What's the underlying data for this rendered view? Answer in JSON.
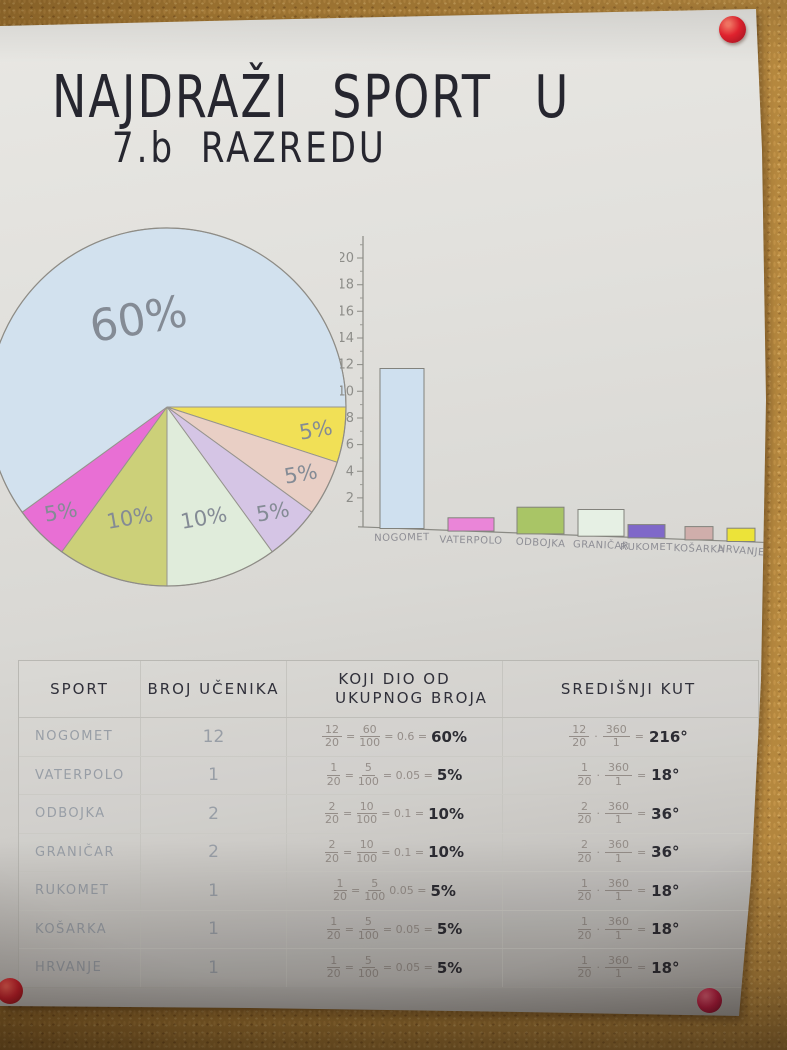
{
  "colors": {
    "cork_board": "#a97c35",
    "poster_paper": "#dddcd8",
    "ink": "#2b2b33",
    "pencil": "#8f939b",
    "pin_red": "#ea2430",
    "pin_crimson": "#bd1c42"
  },
  "title": {
    "line1": "NAJDRAŽI SPORT U",
    "line2": "7.b RAZREDU"
  },
  "chart_data": [
    {
      "type": "pie",
      "title": "NAJDRAŽI SPORT U 7.b RAZREDU",
      "total_students": 20,
      "layout": "slices drawn clockwise starting at 3 o'clock; 60% slice fills remainder",
      "slices": [
        {
          "sport": "HRVANJE",
          "percent": 5,
          "label": "5%",
          "color": "#f1e056"
        },
        {
          "sport": "KOŠARKA",
          "percent": 5,
          "label": "5%",
          "color": "#e9cfc5"
        },
        {
          "sport": "RUKOMET",
          "percent": 5,
          "label": "5%",
          "color": "#d5c5e5"
        },
        {
          "sport": "GRANIČAR",
          "percent": 10,
          "label": "10%",
          "color": "#e0ecdb"
        },
        {
          "sport": "ODBOJKA",
          "percent": 10,
          "label": "10%",
          "color": "#ccd079"
        },
        {
          "sport": "VATERPOLO",
          "percent": 5,
          "label": "5%",
          "color": "#e86fd4"
        },
        {
          "sport": "NOGOMET",
          "percent": 60,
          "label": "60%",
          "color": "#d2e1ee"
        }
      ]
    },
    {
      "type": "bar",
      "title": "",
      "xlabel": "",
      "ylabel": "",
      "categories": [
        "NOGOMET",
        "VATERPOLO",
        "ODBOJKA",
        "GRANIČAR",
        "RUKOMET",
        "KOŠARKA",
        "HRVANJE"
      ],
      "values": [
        12,
        1,
        2,
        2,
        1,
        1,
        1
      ],
      "bar_colors": [
        "#cfe0ef",
        "#ea85d8",
        "#a9c566",
        "#e6f0e4",
        "#7f68c9",
        "#d0aeab",
        "#ece339"
      ],
      "yticks": [
        2,
        4,
        6,
        8,
        10,
        12,
        14,
        16,
        18,
        20
      ],
      "ylim": [
        0,
        21
      ],
      "grid": false,
      "legend": "none"
    },
    {
      "type": "table",
      "headers": {
        "col1": "SPORT",
        "col2": "BROJ UČENIKA",
        "col3a": "KOJI DIO OD",
        "col3b": "UKUPNOG BROJA",
        "col4": "SREDIŠNJI KUT"
      },
      "rows": [
        {
          "sport": "NOGOMET",
          "broj": "12",
          "dio": {
            "f1n": "12",
            "f1d": "20",
            "eq": "=",
            "f2n": "60",
            "f2d": "100",
            "mid": "= 0.6 =",
            "res": "60%"
          },
          "kut": {
            "f1n": "12",
            "f1d": "20",
            "dot": "·",
            "f2n": "360",
            "f2d": "1",
            "eq": "=",
            "res": "216°"
          }
        },
        {
          "sport": "VATERPOLO",
          "broj": "1",
          "dio": {
            "f1n": "1",
            "f1d": "20",
            "eq": "=",
            "f2n": "5",
            "f2d": "100",
            "mid": "= 0.05 =",
            "res": "5%"
          },
          "kut": {
            "f1n": "1",
            "f1d": "20",
            "dot": "·",
            "f2n": "360",
            "f2d": "1",
            "eq": "=",
            "res": "18°"
          }
        },
        {
          "sport": "ODBOJKA",
          "broj": "2",
          "dio": {
            "f1n": "2",
            "f1d": "20",
            "eq": "=",
            "f2n": "10",
            "f2d": "100",
            "mid": "= 0.1 =",
            "res": "10%"
          },
          "kut": {
            "f1n": "2",
            "f1d": "20",
            "dot": "·",
            "f2n": "360",
            "f2d": "1",
            "eq": "=",
            "res": "36°"
          }
        },
        {
          "sport": "GRANIČAR",
          "broj": "2",
          "dio": {
            "f1n": "2",
            "f1d": "20",
            "eq": "=",
            "f2n": "10",
            "f2d": "100",
            "mid": "= 0.1 =",
            "res": "10%"
          },
          "kut": {
            "f1n": "2",
            "f1d": "20",
            "dot": "·",
            "f2n": "360",
            "f2d": "1",
            "eq": "=",
            "res": "36°"
          }
        },
        {
          "sport": "RUKOMET",
          "broj": "1",
          "dio": {
            "f1n": "1",
            "f1d": "20",
            "eq": "=",
            "f2n": "5",
            "f2d": "100",
            "mid": "0.05 =",
            "res": "5%"
          },
          "kut": {
            "f1n": "1",
            "f1d": "20",
            "dot": "·",
            "f2n": "360",
            "f2d": "1",
            "eq": "=",
            "res": "18°"
          }
        },
        {
          "sport": "KOŠARKA",
          "broj": "1",
          "dio": {
            "f1n": "1",
            "f1d": "20",
            "eq": "=",
            "f2n": "5",
            "f2d": "100",
            "mid": "= 0.05 =",
            "res": "5%"
          },
          "kut": {
            "f1n": "1",
            "f1d": "20",
            "dot": "·",
            "f2n": "360",
            "f2d": "1",
            "eq": "=",
            "res": "18°"
          }
        },
        {
          "sport": "HRVANJE",
          "broj": "1",
          "dio": {
            "f1n": "1",
            "f1d": "20",
            "eq": "=",
            "f2n": "5",
            "f2d": "100",
            "mid": "= 0.05 =",
            "res": "5%"
          },
          "kut": {
            "f1n": "1",
            "f1d": "20",
            "dot": "·",
            "f2n": "360",
            "f2d": "1",
            "eq": "=",
            "res": "18°"
          }
        }
      ]
    }
  ]
}
